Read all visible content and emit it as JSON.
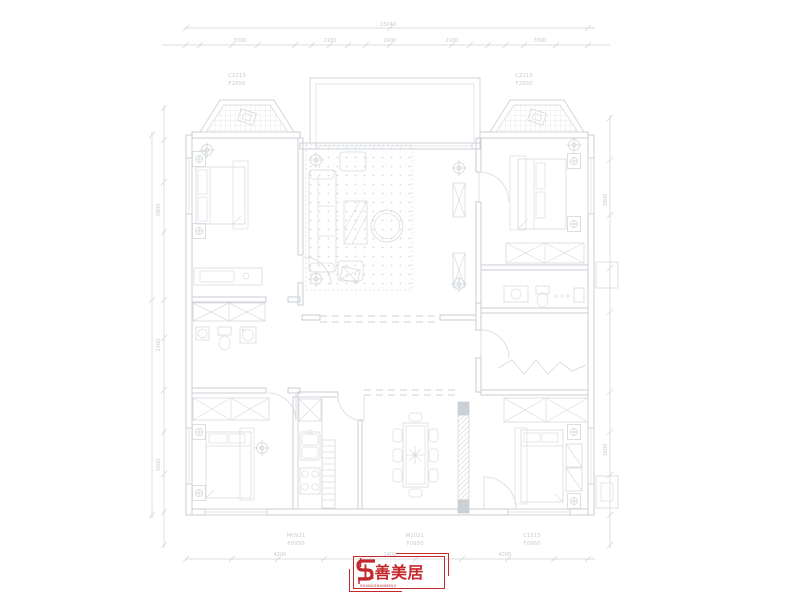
{
  "canvas": {
    "background": "#ffffff"
  },
  "colors": {
    "wall_line": "#c9ced4",
    "furniture_line": "#d5d9dd",
    "dimension_line": "#cdd2d7",
    "label_text": "#c9cdd2",
    "logo_red": "#c5282c"
  },
  "dimensions": {
    "overall_top": "15240",
    "top_segments": [
      "3300",
      "2100",
      "2400",
      "2100",
      "3300"
    ],
    "left_segments": [
      "3900",
      "2100",
      "3600"
    ],
    "right_segments": [
      "3900",
      "3600"
    ],
    "bottom_segments": [
      "4200",
      "2400",
      "4200"
    ]
  },
  "labels": {
    "bay_left": {
      "line1": "C2215",
      "line2": "F2650"
    },
    "bay_right": {
      "line1": "C2215",
      "line2": "F2650"
    },
    "kitchen_door": {
      "line1": "M0921",
      "line2": "F0950"
    },
    "dining_door": {
      "line1": "M1021",
      "line2": "F0950"
    },
    "bedroom4_window": {
      "line1": "C1515",
      "line2": "F0950"
    }
  },
  "logo": {
    "name": "上善美居",
    "subline": "SHANGSHANMEIJU"
  }
}
